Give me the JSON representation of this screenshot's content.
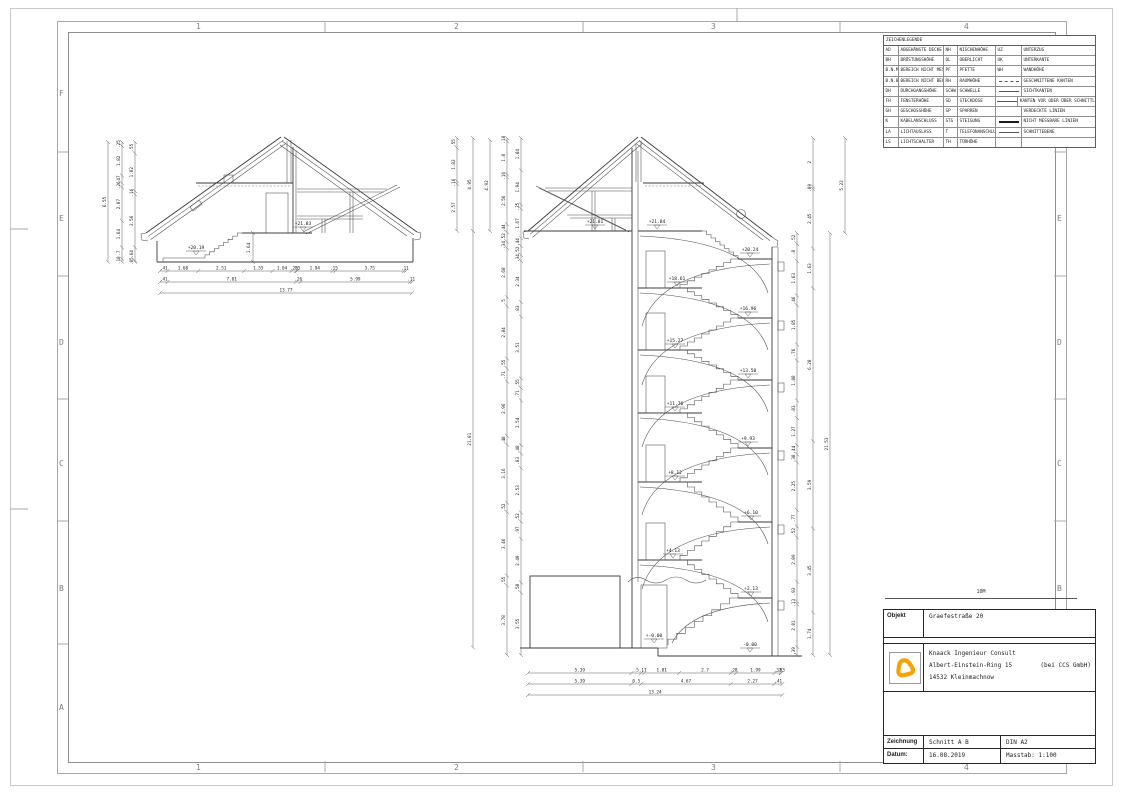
{
  "grid": {
    "cols": [
      "1",
      "2",
      "3",
      "4"
    ],
    "rows": [
      "F",
      "E",
      "D",
      "C",
      "B",
      "A"
    ]
  },
  "legend": {
    "title": "ZEICHENLEGENDE",
    "entries_col1": [
      [
        "AD",
        "ABGEHÄNGTE DECKE"
      ],
      [
        "BH",
        "BRÜSTUNGSHÖHE"
      ],
      [
        "B.N.M",
        "BEREICH NICHT MESSBAR"
      ],
      [
        "B.N.B",
        "BEREICH NICHT BEGEHBAR"
      ],
      [
        "DH",
        "DURCHGANGSHÖHE"
      ],
      [
        "FH",
        "FENSTERHÖHE"
      ],
      [
        "GH",
        "GESCHOSSHÖHE"
      ],
      [
        "K",
        "KABELANSCHLUSS"
      ],
      [
        "LA",
        "LICHTAUSLASS"
      ],
      [
        "LS",
        "LICHTSCHALTER"
      ]
    ],
    "entries_col2": [
      [
        "NH",
        "NISCHENHÖHE"
      ],
      [
        "OL",
        "OBERLICHT"
      ],
      [
        "PF",
        "PFETTE"
      ],
      [
        "RH",
        "RAUMHÖHE"
      ],
      [
        "SCHW",
        "SCHWELLE"
      ],
      [
        "SD",
        "STECKDOSE"
      ],
      [
        "SP",
        "SPARREN"
      ],
      [
        "STG",
        "STEIGUNG"
      ],
      [
        "T",
        "TELEFONANSCHLUSS"
      ],
      [
        "TH",
        "TÜRHÖHE"
      ]
    ],
    "entries_col3": [
      {
        "kind": "text",
        "abbr": "UZ",
        "label": "UNTERZUG"
      },
      {
        "kind": "text",
        "abbr": "UK",
        "label": "UNTERKANTE"
      },
      {
        "kind": "text",
        "abbr": "WH",
        "label": "WANDHÖHE"
      },
      {
        "kind": "line",
        "style": "dashed",
        "label": "GESCHNITTENE KANTEN"
      },
      {
        "kind": "line",
        "style": "thin",
        "label": "SICHTKANTEN"
      },
      {
        "kind": "line",
        "style": "thin",
        "label": "KANTEN VOR ODER ÜBER SCHNITTLINIEN"
      },
      {
        "kind": "line",
        "style": "none",
        "label": "VERDECKTE LINIEN"
      },
      {
        "kind": "line",
        "style": "thick",
        "label": "NICHT MESSBARE LINIEN"
      },
      {
        "kind": "line",
        "style": "thin",
        "label": "SCHNITTEBENE"
      },
      {
        "kind": "empty",
        "label": ""
      }
    ]
  },
  "scalebar": {
    "label": "10M"
  },
  "titleblock": {
    "objekt_label": "Objekt",
    "objekt_value": "Graefestraße 20",
    "company_line1": "Knaack Ingenieur Consult",
    "company_line2": "Albert-Einstein-Ring 15",
    "company_line2b": "(bei CCS GmbH)",
    "company_line3": "14532 Kleinmachnow",
    "zeichnung_label": "Zeichnung",
    "zeichnung_value": "Schnitt A B",
    "format_value": "DIN A2",
    "datum_label": "Datum:",
    "datum_value": "16.08.2019",
    "masstab_value": "Masstab: 1:100",
    "logo_color": "#F2A30A"
  },
  "left_drawing": {
    "levels": [
      "+20.19",
      "+21.83"
    ],
    "interior_dim": "1.64",
    "dim_rows_bottom": [
      [
        ".41",
        "1.68",
        "2.51",
        "1.55",
        "1.04",
        ".25",
        ".05",
        "1.94",
        ".15",
        "3.75",
        ".11"
      ],
      [
        ".41",
        "7.01",
        ".26",
        "5.99",
        ".11"
      ],
      [
        "13.77"
      ]
    ],
    "dim_cols_left": {
      "total": [
        "6.55"
      ],
      "mid": [
        ".25",
        "1.82",
        ".47",
        ".26",
        "2.07",
        "1.64",
        ".7",
        ".18"
      ],
      "inner": [
        ".55",
        "1.82",
        ".16",
        "2.56",
        ".64",
        ".05"
      ]
    }
  },
  "right_drawing": {
    "levels": [
      "+21.81",
      "+21.84",
      "+20.24",
      "+18.61",
      "+16.96",
      "+15.27",
      "+13.50",
      "+11.76",
      "+9.93",
      "+8.12",
      "+6.10",
      "+4.13",
      "+2.13",
      "+-0.00",
      "-0.00"
    ],
    "dim_rows_bottom": [
      [
        "5.39",
        ".5",
        ".17",
        "1.81",
        "2.7",
        ".28",
        "1.99",
        ".32",
        ".03"
      ],
      [
        "5.39",
        "0.5",
        "4.67",
        "2.27",
        ".41"
      ],
      [
        "13.24"
      ]
    ],
    "dim_cols_left": {
      "a": [
        ".55",
        "1.82",
        ".16",
        "2.57"
      ],
      "b_roof": [
        "4.95"
      ],
      "b_body": [
        "21.81"
      ],
      "c": [
        "4.92"
      ],
      "d": [
        ".18",
        "1.8",
        ".16",
        "2.56",
        ".44",
        ".52",
        ".34",
        "2.68",
        ".5",
        "2.84",
        ".55",
        ".71",
        "2.96",
        ".48",
        "3.16",
        ".52",
        "3.46",
        ".55",
        "3.78"
      ],
      "e": [
        "1.84",
        "1.94",
        ".25",
        "1.67",
        ".44",
        ".52",
        ".34",
        "2.34",
        ".83",
        "3.51",
        ".55",
        ".71",
        "2.54",
        ".48",
        ".83",
        "2.53",
        ".52",
        ".97",
        "2.49",
        ".58",
        "3.55"
      ]
    },
    "dim_cols_right": {
      "f": [
        ".52",
        ".8",
        "1.63",
        ".46",
        "1.85",
        ".76",
        "1.88",
        ".83",
        "1.27",
        ".44",
        ".38",
        "2.25",
        ".77",
        ".52",
        "2.09",
        ".93",
        ".13",
        "2.01",
        ".39"
      ],
      "g": [
        "2",
        ".09",
        "2.45",
        "1.63",
        "6.28",
        "3.59",
        "3.45",
        "1.74"
      ],
      "h": [
        "21.53"
      ],
      "i": [
        "5.22"
      ]
    }
  }
}
